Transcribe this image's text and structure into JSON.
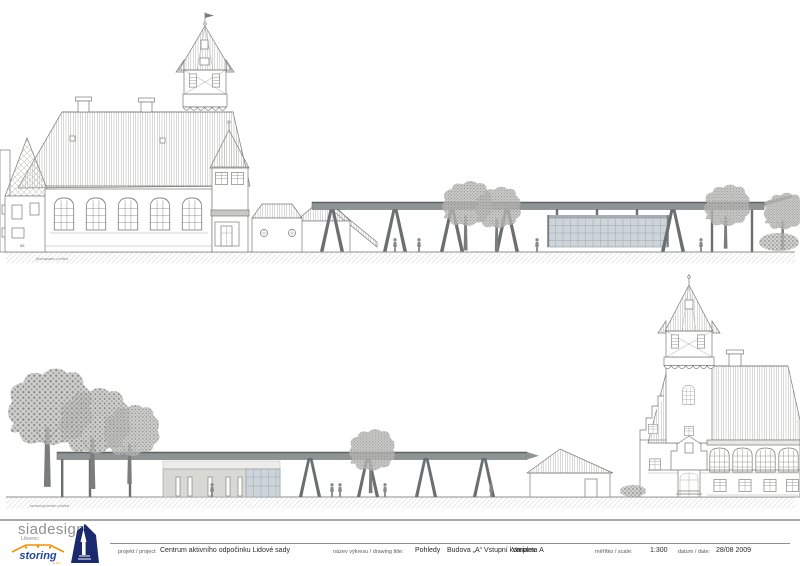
{
  "drawing": {
    "views": {
      "top": {
        "label": "jihozápadní pohled",
        "facade_mark": "88"
      },
      "bottom": {
        "label": "severovýchodní pohled"
      }
    },
    "colors": {
      "canopy": "#8e9494",
      "support": "#6a706f",
      "glass": "#cdd5da",
      "wall": "#d8d8d4",
      "line": "#7a7a78",
      "tree": "#8a8a88",
      "brand_gray": "#8e9092",
      "logo_blue": "#2146a0",
      "logo_orange": "#f39200",
      "logo_navy": "#1b2a6e"
    }
  },
  "title_block": {
    "logo": {
      "brand": "siadesign",
      "brand_sub": "Liberec",
      "partner": "storing",
      "partner_sub": "s.r.o."
    },
    "project": {
      "label": "projekt / project",
      "value": "Centrum aktivního odpočinku Lidové sady"
    },
    "drawing_title": {
      "label": "název výkresu / drawing title:",
      "value": "Pohledy"
    },
    "building": {
      "value": "Budova „A“ Vstupní komplex"
    },
    "variant": {
      "value": "Varianta A"
    },
    "scale": {
      "label": "měřítko / scale:",
      "value": "1:300"
    },
    "date": {
      "label": "datum / date:",
      "value": "28/08 2009"
    }
  }
}
